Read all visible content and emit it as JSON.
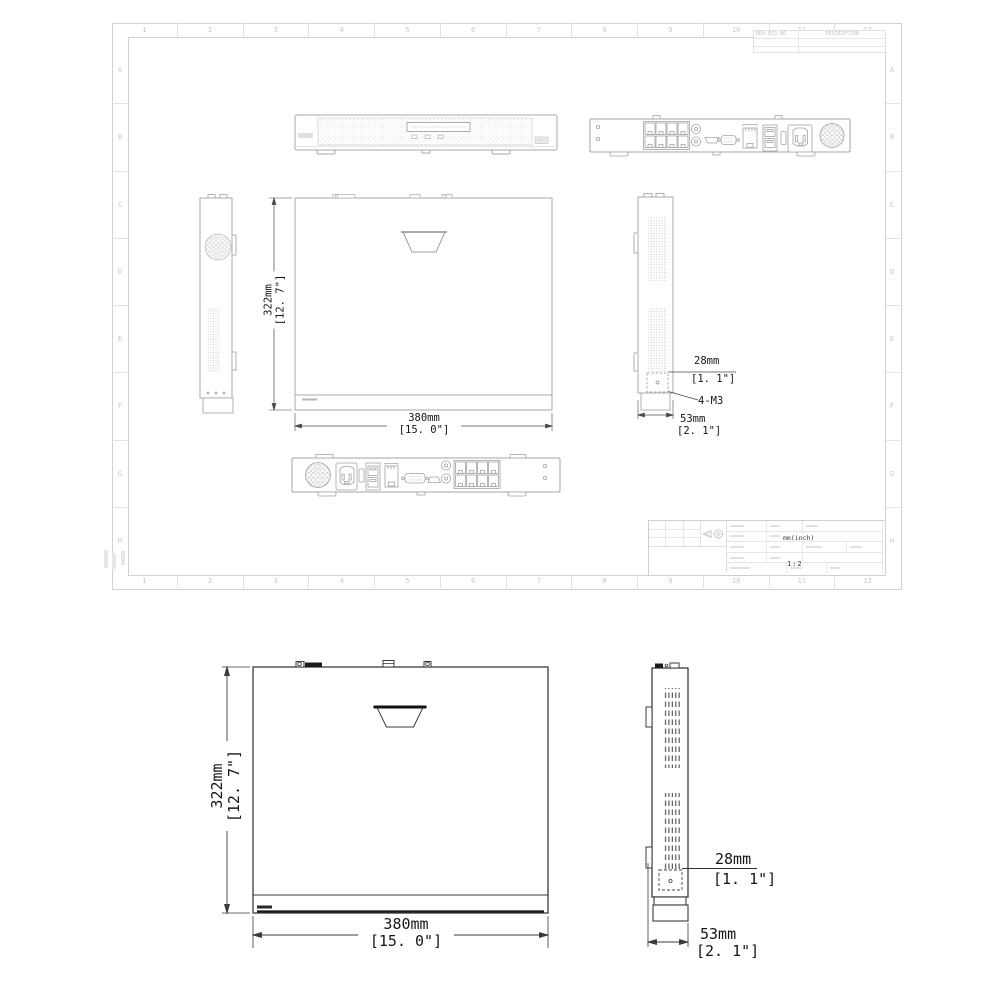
{
  "sheet": {
    "zone_cols": [
      "1",
      "2",
      "3",
      "4",
      "5",
      "6",
      "7",
      "8",
      "9",
      "10",
      "11",
      "12"
    ],
    "zone_rows": [
      "A",
      "B",
      "C",
      "D",
      "E",
      "F",
      "G",
      "H"
    ],
    "revision_table": {
      "header_left": "REV ECO NO",
      "header_right": "DESCRIPTION"
    },
    "title_block": {
      "units": "mm(inch)",
      "scale": "1:2"
    }
  },
  "dimensions": {
    "height_mm": "322mm",
    "height_in": "[12. 7\"]",
    "width_mm": "380mm",
    "width_in": "[15. 0\"]",
    "depth_mm": "53mm",
    "depth_in": "[2. 1\"]",
    "bracket_mm": "28mm",
    "bracket_in": "[1. 1\"]",
    "screw_label": "4-M3"
  },
  "colors": {
    "sheet_line": "#d2d2d2",
    "drawing_light": "#a8a8a8",
    "drawing_dark": "#3a3a3a",
    "dim_text": "#161616"
  }
}
